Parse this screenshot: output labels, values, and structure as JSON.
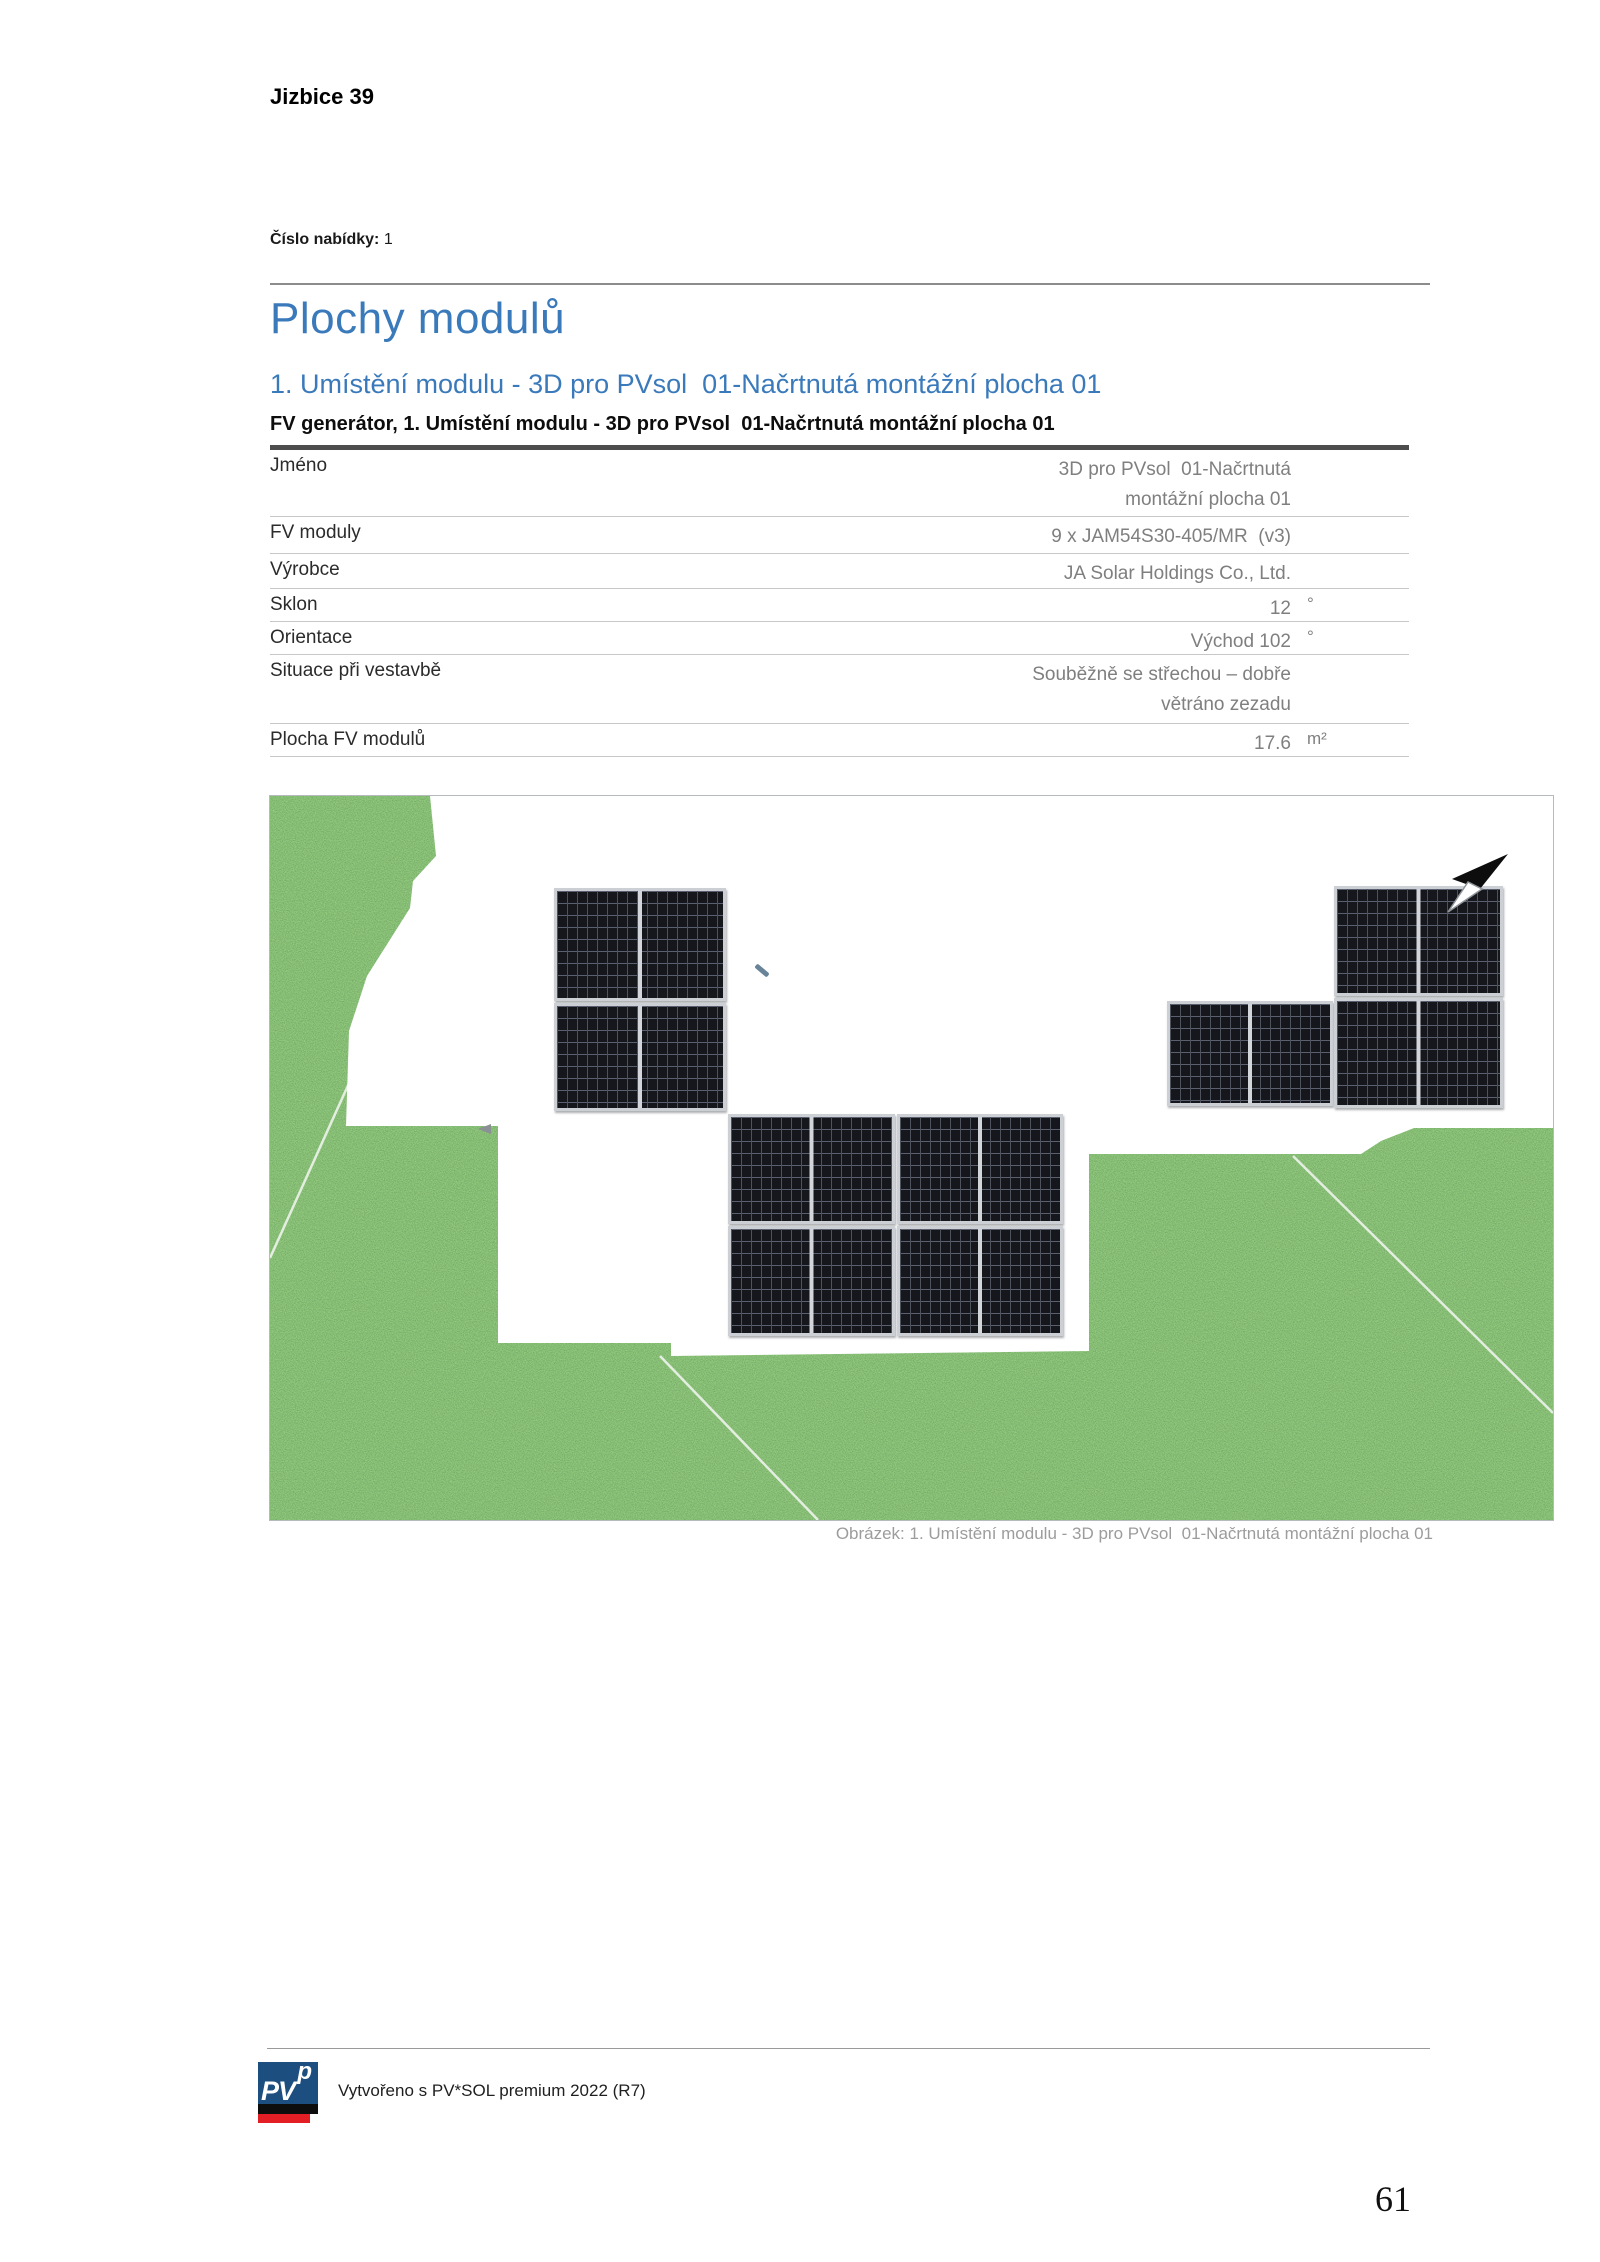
{
  "page": {
    "project": "Jizbice 39",
    "offer_label": "Číslo nabídky:",
    "offer_value": "1",
    "page_number": "61"
  },
  "section": {
    "title": "Plochy modulů",
    "subtitle": "1. Umístění modulu - 3D pro PVsol  01-Načrtnutá montážní plocha 01"
  },
  "table": {
    "title": "FV generátor, 1. Umístění modulu - 3D pro PVsol  01-Načrtnutá montážní plocha 01",
    "rows": [
      {
        "label": "Jméno",
        "value": "3D pro PVsol  01-Načrtnutá\nmontážní plocha 01",
        "unit": ""
      },
      {
        "label": "FV moduly",
        "value": "9 x JAM54S30-405/MR  (v3)",
        "unit": ""
      },
      {
        "label": "Výrobce",
        "value": "JA Solar Holdings Co., Ltd.",
        "unit": ""
      },
      {
        "label": "Sklon",
        "value": "12",
        "unit": "°"
      },
      {
        "label": "Orientace",
        "value": "Východ 102",
        "unit": "°"
      },
      {
        "label": "Situace při vestavbě",
        "value": "Souběžně se střechou – dobře\nvětráno zezadu",
        "unit": ""
      },
      {
        "label": "Plocha FV modulů",
        "value": "17.6",
        "unit": "m²"
      }
    ]
  },
  "figure": {
    "caption": "Obrázek: 1. Umístění modulu - 3D pro PVsol  01-Načrtnutá montážní plocha 01",
    "module_count": 9,
    "icons": [
      "north-arrow-icon"
    ],
    "colors": {
      "grass_green": "#4f9d3b",
      "roof_white": "#ffffff",
      "module_cells": "#15171c",
      "module_frame": "#ccd0d5"
    }
  },
  "footer": {
    "credit": "Vytvořeno s PV*SOL premium 2022 (R7)",
    "logo_main": "PV",
    "logo_sup": "p",
    "logo_colors": {
      "blue": "#1c4e80",
      "black": "#0d0d0d",
      "red": "#e31e24"
    }
  },
  "colors": {
    "heading_blue": "#3a7abb",
    "value_gray": "#7f7f7f",
    "caption_gray": "#9c9c9c"
  }
}
